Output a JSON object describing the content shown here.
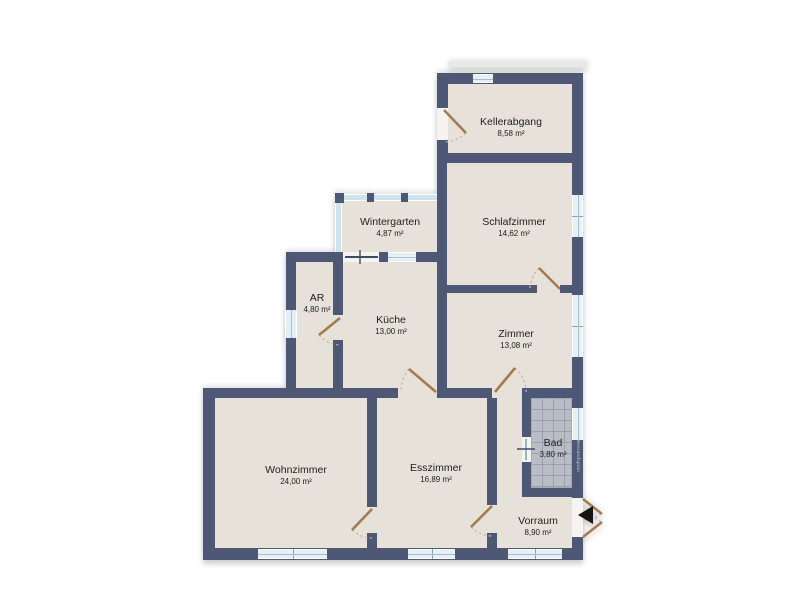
{
  "rooms": [
    {
      "name": "Kellerabgang",
      "area": "8,58 m²"
    },
    {
      "name": "Wintergarten",
      "area": "4,87 m²"
    },
    {
      "name": "Schlafzimmer",
      "area": "14,62 m²"
    },
    {
      "name": "AR",
      "area": "4,80 m²"
    },
    {
      "name": "Küche",
      "area": "13,00 m²"
    },
    {
      "name": "Zimmer",
      "area": "13,08 m²"
    },
    {
      "name": "Wohnzimmer",
      "area": "24,00 m²"
    },
    {
      "name": "Esszimmer",
      "area": "16,89 m²"
    },
    {
      "name": "Bad",
      "area": "3,80 m²"
    },
    {
      "name": "Vorraum",
      "area": "8,90 m²"
    }
  ],
  "watermark": "Bestandsplan",
  "colors": {
    "wall": "#4e5874",
    "floor": "#e6e2d9",
    "window": "#e4eff6",
    "glass": "#cfe3ef",
    "door": "#a57a4e",
    "tile": "#b8bdc6",
    "entrance_marker": "#151515",
    "background": "#ffffff"
  }
}
